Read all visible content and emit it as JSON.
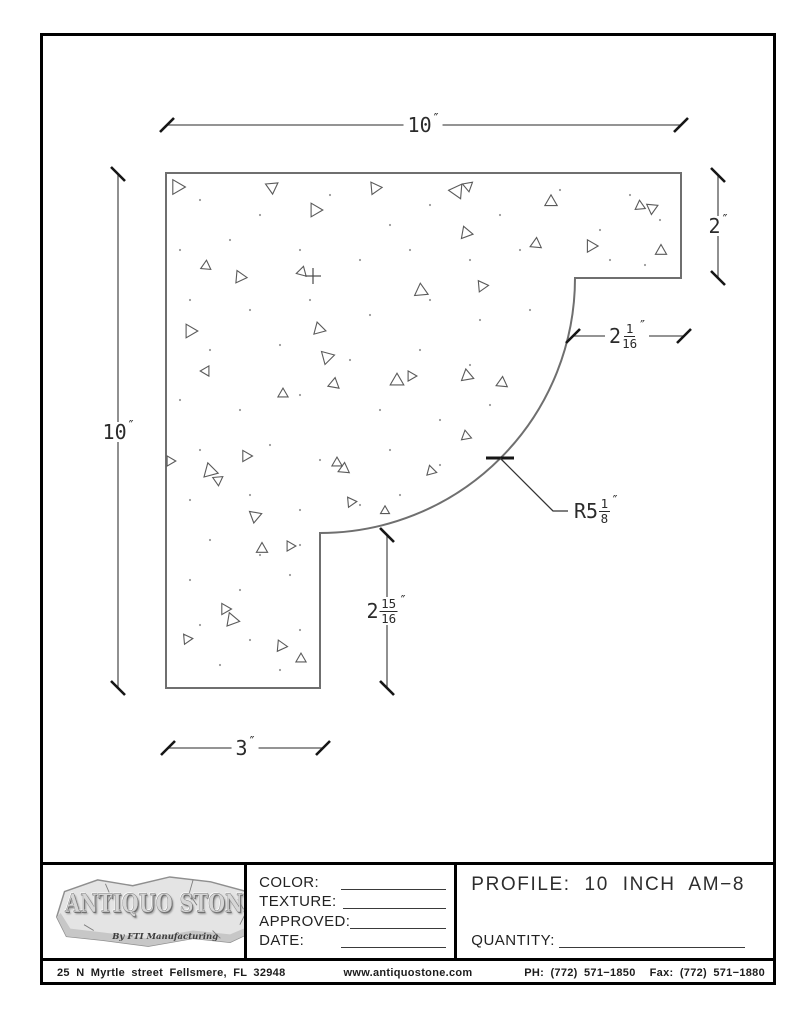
{
  "page": {
    "background": "#ffffff",
    "border_color": "#000000",
    "line_color": "#6f6f6f",
    "dim_color": "#2b2b2b"
  },
  "drawing": {
    "dims": {
      "top": {
        "value": "10",
        "unit": "″"
      },
      "left": {
        "value": "10",
        "unit": "″"
      },
      "right": {
        "value": "2",
        "unit": "″"
      },
      "notch_width": {
        "whole": "2",
        "num": "1",
        "den": "16",
        "unit": "″"
      },
      "step_height": {
        "whole": "2",
        "num": "15",
        "den": "16",
        "unit": "″"
      },
      "bottom": {
        "value": "3",
        "unit": "″"
      },
      "radius": {
        "prefix": "R5",
        "num": "1",
        "den": "8",
        "unit": "″"
      }
    },
    "texture": {
      "triangles": [
        [
          177,
          187,
          13,
          0
        ],
        [
          272,
          187,
          11,
          205
        ],
        [
          375,
          188,
          11,
          355
        ],
        [
          457,
          191,
          13,
          185
        ],
        [
          468,
          186,
          9,
          80
        ],
        [
          551,
          202,
          11,
          150
        ],
        [
          640,
          206,
          9,
          265
        ],
        [
          652,
          208,
          10,
          95
        ],
        [
          315,
          210,
          12,
          0
        ],
        [
          466,
          233,
          11,
          10
        ],
        [
          536,
          244,
          10,
          35
        ],
        [
          591,
          246,
          11,
          0
        ],
        [
          661,
          251,
          10,
          270
        ],
        [
          206,
          266,
          9,
          275
        ],
        [
          240,
          277,
          11,
          5
        ],
        [
          302,
          272,
          9,
          45
        ],
        [
          421,
          291,
          12,
          25
        ],
        [
          482,
          286,
          10,
          355
        ],
        [
          190,
          331,
          12,
          0
        ],
        [
          319,
          329,
          11,
          15
        ],
        [
          327,
          357,
          12,
          225
        ],
        [
          283,
          394,
          9,
          270
        ],
        [
          334,
          384,
          10,
          40
        ],
        [
          206,
          371,
          9,
          60
        ],
        [
          397,
          381,
          12,
          30
        ],
        [
          411,
          376,
          9,
          0
        ],
        [
          467,
          376,
          11,
          20
        ],
        [
          502,
          383,
          10,
          275
        ],
        [
          170,
          461,
          9,
          0
        ],
        [
          210,
          471,
          13,
          15
        ],
        [
          218,
          480,
          9,
          205
        ],
        [
          246,
          456,
          10,
          0
        ],
        [
          337,
          463,
          9,
          270
        ],
        [
          344,
          469,
          10,
          35
        ],
        [
          431,
          471,
          9,
          15
        ],
        [
          466,
          436,
          9,
          20
        ],
        [
          351,
          502,
          9,
          355
        ],
        [
          385,
          511,
          8,
          270
        ],
        [
          255,
          516,
          11,
          220
        ],
        [
          262,
          549,
          10,
          30
        ],
        [
          290,
          546,
          9,
          0
        ],
        [
          225,
          609,
          10,
          0
        ],
        [
          232,
          620,
          12,
          10
        ],
        [
          187,
          639,
          9,
          355
        ],
        [
          281,
          646,
          10,
          5
        ],
        [
          301,
          659,
          9,
          270
        ]
      ],
      "dots": [
        [
          200,
          200
        ],
        [
          260,
          215
        ],
        [
          330,
          195
        ],
        [
          390,
          225
        ],
        [
          430,
          205
        ],
        [
          500,
          215
        ],
        [
          560,
          190
        ],
        [
          600,
          230
        ],
        [
          630,
          195
        ],
        [
          660,
          220
        ],
        [
          180,
          250
        ],
        [
          230,
          240
        ],
        [
          300,
          250
        ],
        [
          360,
          260
        ],
        [
          410,
          250
        ],
        [
          470,
          260
        ],
        [
          520,
          250
        ],
        [
          610,
          260
        ],
        [
          645,
          265
        ],
        [
          190,
          300
        ],
        [
          250,
          310
        ],
        [
          310,
          300
        ],
        [
          370,
          315
        ],
        [
          430,
          300
        ],
        [
          480,
          320
        ],
        [
          530,
          310
        ],
        [
          210,
          350
        ],
        [
          280,
          345
        ],
        [
          350,
          360
        ],
        [
          420,
          350
        ],
        [
          470,
          365
        ],
        [
          180,
          400
        ],
        [
          240,
          410
        ],
        [
          300,
          395
        ],
        [
          380,
          410
        ],
        [
          440,
          420
        ],
        [
          490,
          405
        ],
        [
          200,
          450
        ],
        [
          270,
          445
        ],
        [
          320,
          460
        ],
        [
          390,
          450
        ],
        [
          440,
          465
        ],
        [
          190,
          500
        ],
        [
          250,
          495
        ],
        [
          300,
          510
        ],
        [
          360,
          505
        ],
        [
          400,
          495
        ],
        [
          210,
          540
        ],
        [
          260,
          555
        ],
        [
          300,
          545
        ],
        [
          190,
          580
        ],
        [
          240,
          590
        ],
        [
          290,
          575
        ],
        [
          200,
          625
        ],
        [
          250,
          640
        ],
        [
          300,
          630
        ],
        [
          220,
          665
        ],
        [
          280,
          670
        ]
      ]
    }
  },
  "titleblock": {
    "fields": [
      {
        "label": "COLOR:"
      },
      {
        "label": "TEXTURE:"
      },
      {
        "label": "APPROVED:"
      },
      {
        "label": "DATE:"
      }
    ],
    "profile_label": "PROFILE: 10 INCH AM−8",
    "quantity_label": "QUANTITY:",
    "logo": {
      "title": "ANTIQUO STONE",
      "subtitle": "By FTI Manufacturing"
    }
  },
  "footer": {
    "address": "25 N Myrtle street Fellsmere, FL 32948",
    "website": "www.antiquostone.com",
    "phone": "PH: (772) 571−1850",
    "fax": "Fax: (772) 571−1880"
  }
}
